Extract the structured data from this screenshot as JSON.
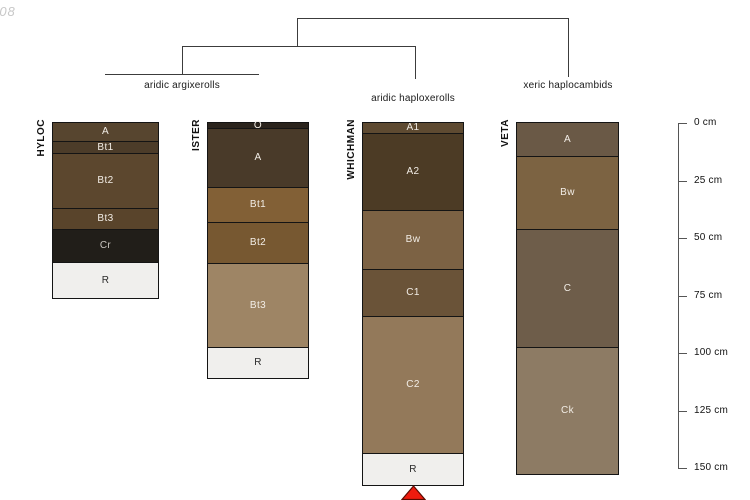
{
  "watermark": "-08",
  "dendrogram": {
    "groups": [
      {
        "label": "aridic argixerolls",
        "members": [
          "HYLOC",
          "ISTER"
        ]
      },
      {
        "label": "aridic haploxerolls",
        "members": [
          "WHICHMAN"
        ]
      },
      {
        "label": "xeric haplocambids",
        "members": [
          "VETA"
        ]
      }
    ]
  },
  "depth_axis": {
    "unit": "cm",
    "tick_labels": [
      "0 cm",
      "25 cm",
      "50 cm",
      "75 cm",
      "100 cm",
      "125 cm",
      "150 cm"
    ],
    "tick_values_cm": [
      0,
      25,
      50,
      75,
      100,
      125,
      150
    ]
  },
  "marker": {
    "shape": "triangle-up",
    "color": "#ee1b0e",
    "outline_color": "#5a0a00",
    "under_profile": "WHICHMAN"
  },
  "chart_data": {
    "type": "soil-profile-depth-diagram",
    "title": "",
    "ylabel": "depth (cm)",
    "ylim_cm": [
      0,
      150
    ],
    "legend_position": "none",
    "profiles": [
      {
        "name": "HYLOC",
        "group": "aridic argixerolls",
        "horizons": [
          {
            "label": "A",
            "top_cm": 0,
            "bottom_cm": 8,
            "color": "#57452f",
            "label_color": "#f2ede6"
          },
          {
            "label": "Bt1",
            "top_cm": 8,
            "bottom_cm": 13,
            "color": "#4c3c29",
            "label_color": "#f2ede6"
          },
          {
            "label": "Bt2",
            "top_cm": 13,
            "bottom_cm": 37,
            "color": "#5c472e",
            "label_color": "#f2ede6"
          },
          {
            "label": "Bt3",
            "top_cm": 37,
            "bottom_cm": 46,
            "color": "#59442b",
            "label_color": "#f2ede6"
          },
          {
            "label": "Cr",
            "top_cm": 46,
            "bottom_cm": 60.5,
            "color": "#211e19",
            "label_color": "#c9c5bf"
          },
          {
            "label": "R",
            "top_cm": 60.5,
            "bottom_cm": 76,
            "color": "#f0efed",
            "label_color": "#2a2a2a"
          }
        ]
      },
      {
        "name": "ISTER",
        "group": "aridic argixerolls",
        "horizons": [
          {
            "label": "O",
            "top_cm": 0,
            "bottom_cm": 2,
            "color": "#2b241d",
            "label_color": "#f2ede6"
          },
          {
            "label": "A",
            "top_cm": 2,
            "bottom_cm": 28,
            "color": "#493a29",
            "label_color": "#f2ede6"
          },
          {
            "label": "Bt1",
            "top_cm": 28,
            "bottom_cm": 43,
            "color": "#826036",
            "label_color": "#f2ede6"
          },
          {
            "label": "Bt2",
            "top_cm": 43,
            "bottom_cm": 61,
            "color": "#775831",
            "label_color": "#f2ede6"
          },
          {
            "label": "Bt3",
            "top_cm": 61,
            "bottom_cm": 97.5,
            "color": "#9e8565",
            "label_color": "#f2ede6"
          },
          {
            "label": "R",
            "top_cm": 97.5,
            "bottom_cm": 111,
            "color": "#f0efed",
            "label_color": "#2a2a2a"
          }
        ]
      },
      {
        "name": "WHICHMAN",
        "group": "aridic haploxerolls",
        "horizons": [
          {
            "label": "A1",
            "top_cm": 0,
            "bottom_cm": 4.5,
            "color": "#5e4a31",
            "label_color": "#f2ede6"
          },
          {
            "label": "A2",
            "top_cm": 4.5,
            "bottom_cm": 38,
            "color": "#4c3b25",
            "label_color": "#f2ede6"
          },
          {
            "label": "Bw",
            "top_cm": 38,
            "bottom_cm": 63.5,
            "color": "#7c6244",
            "label_color": "#f2ede6"
          },
          {
            "label": "C1",
            "top_cm": 63.5,
            "bottom_cm": 84,
            "color": "#6a5338",
            "label_color": "#f2ede6"
          },
          {
            "label": "C2",
            "top_cm": 84,
            "bottom_cm": 143.5,
            "color": "#93795a",
            "label_color": "#f2ede6"
          },
          {
            "label": "R",
            "top_cm": 143.5,
            "bottom_cm": 157.5,
            "color": "#f0efed",
            "label_color": "#2a2a2a"
          }
        ]
      },
      {
        "name": "VETA",
        "group": "xeric haplocambids",
        "horizons": [
          {
            "label": "A",
            "top_cm": 0,
            "bottom_cm": 14.5,
            "color": "#6a5946",
            "label_color": "#f2ede6"
          },
          {
            "label": "Bw",
            "top_cm": 14.5,
            "bottom_cm": 46,
            "color": "#7c6342",
            "label_color": "#f2ede6"
          },
          {
            "label": "C",
            "top_cm": 46,
            "bottom_cm": 97.5,
            "color": "#6e5d4a",
            "label_color": "#f2ede6"
          },
          {
            "label": "Ck",
            "top_cm": 97.5,
            "bottom_cm": 152.5,
            "color": "#8d7b64",
            "label_color": "#f2ede6"
          }
        ]
      }
    ]
  }
}
